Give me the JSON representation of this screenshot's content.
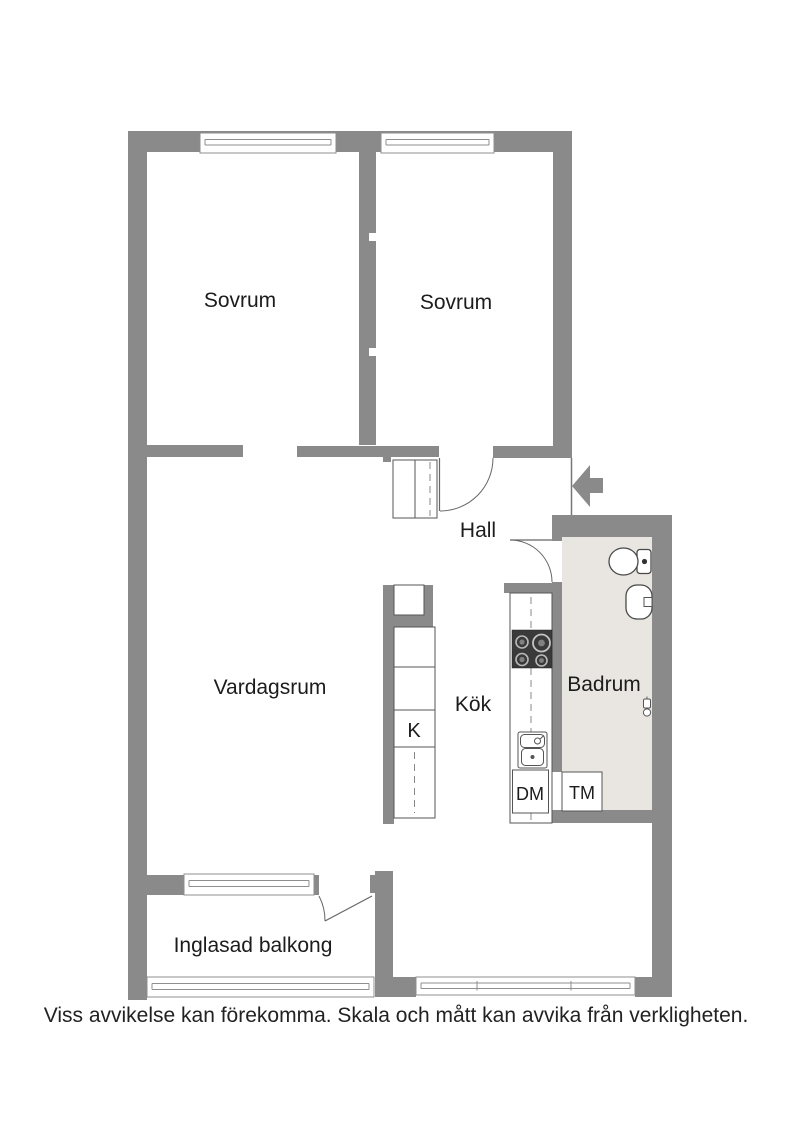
{
  "plan": {
    "rooms": [
      {
        "label": "Sovrum"
      },
      {
        "label": "Sovrum"
      },
      {
        "label": "Hall"
      },
      {
        "label": "Vardagsrum"
      },
      {
        "label": "Kök"
      },
      {
        "label": "Badrum"
      },
      {
        "label": "Inglasad balkong"
      }
    ],
    "closet_label": "K",
    "appliances": [
      {
        "label": "DM"
      },
      {
        "label": "TM"
      }
    ],
    "caption": "Viss avvikelse kan förekomma. Skala och mått kan avvika från verkligheten.",
    "icons": [
      {
        "name": "entrance-arrow-icon"
      },
      {
        "name": "toilet-icon"
      },
      {
        "name": "washbasin-icon"
      },
      {
        "name": "floor-drain-icon"
      },
      {
        "name": "stove-icon"
      },
      {
        "name": "kitchen-sink-icon"
      }
    ],
    "colors": {
      "wall": "#8a8a8a",
      "bathroom_floor": "#e9e6e1",
      "line": "#4a4a4a",
      "background": "#ffffff"
    }
  }
}
